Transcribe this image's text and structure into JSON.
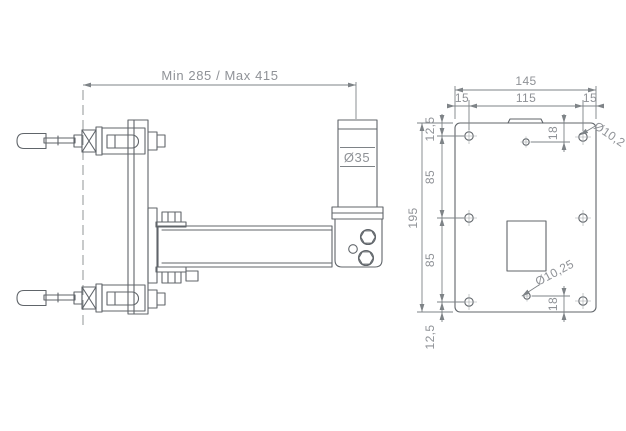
{
  "side_view": {
    "range_label": "Min 285 / Max 415",
    "pole_diameter_label": "Ø35"
  },
  "front_view": {
    "overall_width": "145",
    "edge_to_hole_left": "15",
    "hole_spacing_width": "115",
    "edge_to_hole_right": "15",
    "overall_height": "195",
    "top_edge_offset": "12,5",
    "hole_row_spacing_upper": "85",
    "hole_row_spacing_lower": "85",
    "bottom_edge_offset": "12,5",
    "center_hole_top_offset": "18",
    "center_hole_bottom_offset": "18",
    "hole_diameter_top": "Ø10,2",
    "hole_diameter_bottom": "Ø10,25"
  },
  "colors": {
    "background": "#ffffff",
    "drawing_line": "#60656a",
    "dimension_line": "#7e8387",
    "dimension_text": "#8f9297"
  }
}
